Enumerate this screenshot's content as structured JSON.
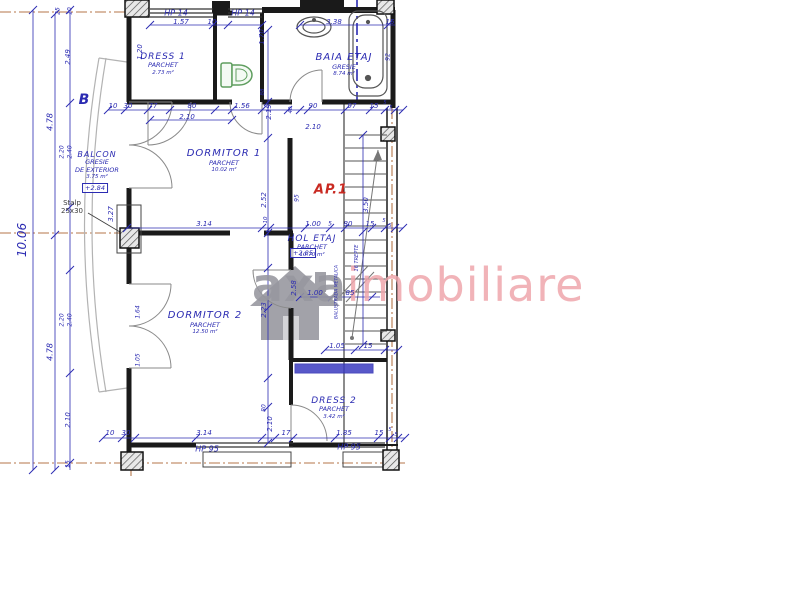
{
  "watermark": {
    "axa": "axa",
    "imobiliare": "imobiliare"
  },
  "colors": {
    "dim_blue": "#2b2bb2",
    "wall_black": "#1a1a1a",
    "axis_brown": "#b5764a",
    "red_label": "#c92a22",
    "watermark_gray": "#96969e",
    "watermark_pink": "#eea6ac",
    "toilet_green": "#5f9e5f"
  },
  "rooms": [
    {
      "id": "dress1",
      "name": "DRESS 1",
      "finish": "PARCHET",
      "area": "2.73 m²",
      "x": 163,
      "y": 52,
      "ns": 9
    },
    {
      "id": "baia",
      "name": "BAIA ETAJ",
      "finish": "GRESIE",
      "area": "8.74 m²",
      "x": 344,
      "y": 52,
      "ns": 10
    },
    {
      "id": "dorm1",
      "name": "DORMITOR 1",
      "finish": "PARCHET",
      "area": "10.02 m²",
      "x": 224,
      "y": 148,
      "ns": 10
    },
    {
      "id": "hol",
      "name": "HOL ETAJ",
      "finish": "PARCHET",
      "area": "10.70 m²",
      "x": 312,
      "y": 234,
      "ns": 9
    },
    {
      "id": "dorm2",
      "name": "DORMITOR 2",
      "finish": "PARCHET",
      "area": "12.50 m²",
      "x": 205,
      "y": 310,
      "ns": 10
    },
    {
      "id": "dress2",
      "name": "DRESS 2",
      "finish": "PARCHET",
      "area": "3.42 m²",
      "x": 334,
      "y": 396,
      "ns": 9
    },
    {
      "id": "balcon",
      "name": "BALCON",
      "finish": "GRESIE",
      "finish2": "DE EXTERIOR",
      "area": "3.75 m²",
      "x": 97,
      "y": 150,
      "ns": 8
    }
  ],
  "notes": [
    {
      "t": "B",
      "x": 84,
      "y": 100,
      "cls": "section"
    },
    {
      "t": "AP.1",
      "x": 331,
      "y": 190,
      "cls": "red"
    },
    {
      "t": "Stalp",
      "x": 72,
      "y": 203,
      "cls": "dark",
      "s": 7
    },
    {
      "t": "25x30",
      "x": 72,
      "y": 211,
      "cls": "dark",
      "s": 7
    },
    {
      "t": "+2.84",
      "x": 95,
      "y": 188,
      "box": true,
      "s": 6.5
    },
    {
      "t": "+2.85",
      "x": 303,
      "y": 253,
      "box": true,
      "s": 6.5
    },
    {
      "t": "16 TREPTE",
      "x": 357,
      "y": 258,
      "rot": true,
      "s": 5
    },
    {
      "t": "BALUSTRADA METALICA",
      "x": 337,
      "y": 292,
      "rot": true,
      "s": 4.5
    }
  ],
  "dims_h": [
    {
      "t": "HP 14",
      "x": 176,
      "y": 13,
      "s": 8
    },
    {
      "t": "HP 14",
      "x": 243,
      "y": 13,
      "s": 8
    },
    {
      "t": "1.57",
      "x": 181,
      "y": 22
    },
    {
      "t": "10",
      "x": 212,
      "y": 22
    },
    {
      "t": "3.38",
      "x": 334,
      "y": 22
    },
    {
      "t": "15",
      "x": 390,
      "y": 22
    },
    {
      "t": "10",
      "x": 113,
      "y": 106
    },
    {
      "t": "30",
      "x": 128,
      "y": 106
    },
    {
      "t": "77",
      "x": 153,
      "y": 106
    },
    {
      "t": "80",
      "x": 192,
      "y": 106
    },
    {
      "t": "1.56",
      "x": 242,
      "y": 106
    },
    {
      "t": "90",
      "x": 313,
      "y": 106
    },
    {
      "t": "97",
      "x": 352,
      "y": 106
    },
    {
      "t": "15",
      "x": 374,
      "y": 106
    },
    {
      "t": "5",
      "x": 385,
      "y": 103,
      "s": 5
    },
    {
      "t": "5",
      "x": 391,
      "y": 108,
      "s": 5
    },
    {
      "t": "2.10",
      "x": 187,
      "y": 117
    },
    {
      "t": "2.10",
      "x": 313,
      "y": 127
    },
    {
      "t": "3.14",
      "x": 204,
      "y": 224
    },
    {
      "t": "1.00",
      "x": 313,
      "y": 224
    },
    {
      "t": "5",
      "x": 330,
      "y": 224,
      "s": 6
    },
    {
      "t": "80",
      "x": 348,
      "y": 224
    },
    {
      "t": "15",
      "x": 370,
      "y": 224
    },
    {
      "t": "5",
      "x": 384,
      "y": 221,
      "s": 5
    },
    {
      "t": "5",
      "x": 390,
      "y": 226,
      "s": 5
    },
    {
      "t": "1.00",
      "x": 315,
      "y": 293
    },
    {
      "t": "85",
      "x": 350,
      "y": 293
    },
    {
      "t": "1.05",
      "x": 337,
      "y": 346
    },
    {
      "t": "15",
      "x": 368,
      "y": 346
    },
    {
      "t": "10",
      "x": 110,
      "y": 433
    },
    {
      "t": "30",
      "x": 126,
      "y": 433
    },
    {
      "t": "3.14",
      "x": 204,
      "y": 433
    },
    {
      "t": "17",
      "x": 286,
      "y": 433
    },
    {
      "t": "1.85",
      "x": 344,
      "y": 433
    },
    {
      "t": "15",
      "x": 379,
      "y": 433
    },
    {
      "t": "5",
      "x": 390,
      "y": 430,
      "s": 5
    },
    {
      "t": "5",
      "x": 396,
      "y": 435,
      "s": 5
    },
    {
      "t": "HP 95",
      "x": 207,
      "y": 449,
      "s": 8
    },
    {
      "t": "HP 95",
      "x": 349,
      "y": 447,
      "s": 8
    }
  ],
  "dims_v": [
    {
      "t": "10.06",
      "x": 22,
      "y": 240,
      "s": 12
    },
    {
      "t": "4.78",
      "x": 50,
      "y": 122,
      "s": 8
    },
    {
      "t": "4.78",
      "x": 50,
      "y": 352,
      "s": 8
    },
    {
      "t": "25",
      "x": 58,
      "y": 11,
      "s": 6
    },
    {
      "t": "10",
      "x": 70,
      "y": 11,
      "s": 6
    },
    {
      "t": "2.49",
      "x": 68,
      "y": 57
    },
    {
      "t": "2.20",
      "x": 62,
      "y": 152,
      "s": 6
    },
    {
      "t": "2.40",
      "x": 70,
      "y": 152,
      "s": 6
    },
    {
      "t": "2.20",
      "x": 62,
      "y": 320,
      "s": 6
    },
    {
      "t": "2.40",
      "x": 70,
      "y": 320,
      "s": 6
    },
    {
      "t": "2.10",
      "x": 68,
      "y": 420
    },
    {
      "t": "15",
      "x": 68,
      "y": 464,
      "s": 6
    },
    {
      "t": "1.20",
      "x": 140,
      "y": 52
    },
    {
      "t": "3.27",
      "x": 111,
      "y": 214
    },
    {
      "t": "1.64",
      "x": 138,
      "y": 312,
      "s": 6
    },
    {
      "t": "1.05",
      "x": 138,
      "y": 360,
      "s": 6
    },
    {
      "t": "1.70",
      "x": 262,
      "y": 37
    },
    {
      "t": "88",
      "x": 263,
      "y": 92,
      "s": 5.5
    },
    {
      "t": "2.19",
      "x": 269,
      "y": 112
    },
    {
      "t": "2.52",
      "x": 264,
      "y": 200
    },
    {
      "t": "95",
      "x": 297,
      "y": 198,
      "s": 6
    },
    {
      "t": "2.58",
      "x": 294,
      "y": 288
    },
    {
      "t": "2.23",
      "x": 264,
      "y": 310
    },
    {
      "t": "80",
      "x": 264,
      "y": 408,
      "s": 6
    },
    {
      "t": "2.10",
      "x": 270,
      "y": 424
    },
    {
      "t": "40",
      "x": 291,
      "y": 110,
      "s": 5.5
    },
    {
      "t": "10",
      "x": 266,
      "y": 220,
      "s": 5.5
    },
    {
      "t": "3.50",
      "x": 366,
      "y": 205
    },
    {
      "t": "92",
      "x": 388,
      "y": 57,
      "s": 6
    }
  ]
}
